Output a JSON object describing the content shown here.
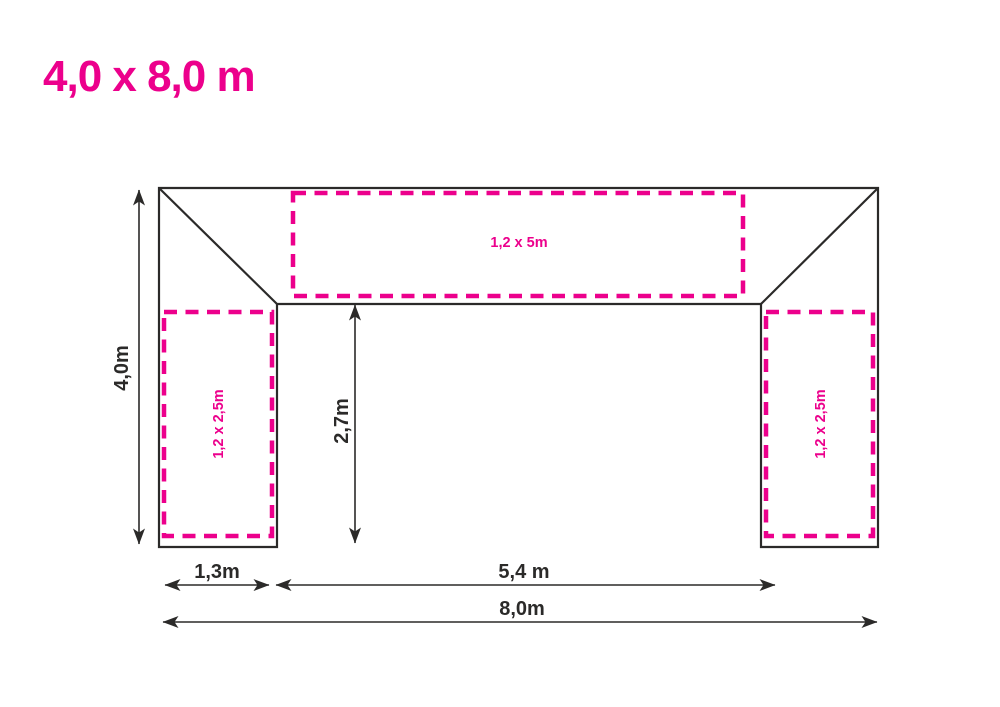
{
  "title": "4,0 x 8,0 m",
  "colors": {
    "accent_pink": "#EC008C",
    "line_dark": "#2B2A29",
    "background": "#FFFFFF"
  },
  "plan": {
    "roof_panel_label": "1,2 x 5m",
    "left_panel_label": "1,2 x 2,5m",
    "right_panel_label": "1,2 x 2,5m",
    "dimensions": {
      "depth_total": "4,0m",
      "depth_inner": "2,7m",
      "side_width": "1,3m",
      "front_opening": "5,4 m",
      "width_total": "8,0m"
    }
  }
}
